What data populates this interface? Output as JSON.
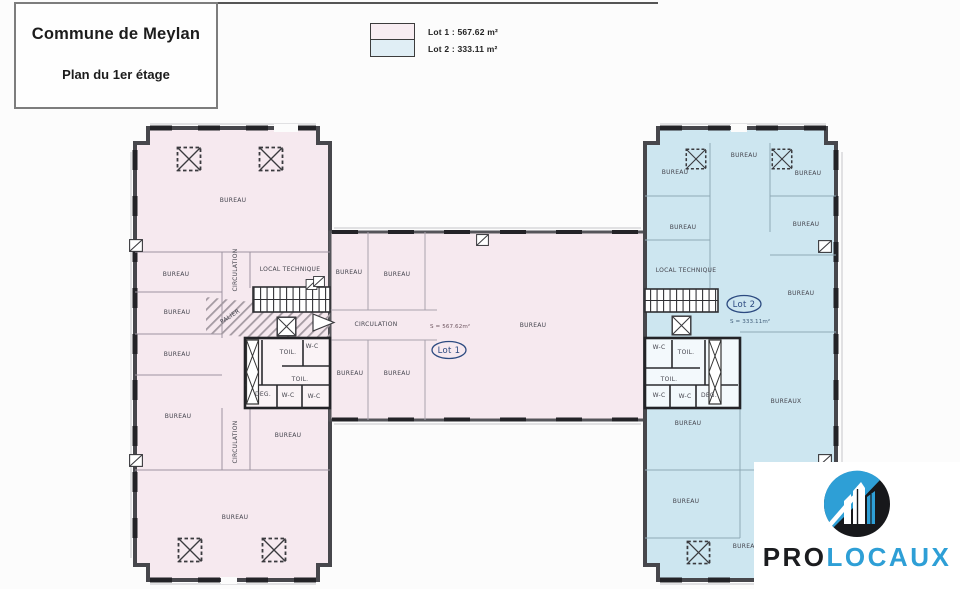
{
  "title_block": {
    "line1": "Commune de Meylan",
    "line2": "Plan du 1er étage"
  },
  "legend": {
    "items": [
      {
        "label": "Lot 1 : 567.62 m²",
        "swatch_color": "#f8edf2"
      },
      {
        "label": "Lot 2 : 333.11 m²",
        "swatch_color": "#e0eef5"
      }
    ]
  },
  "plan": {
    "lot1": {
      "label": "Lot 1",
      "area_label": "S = 567.62m²",
      "fill": "#f6e9ef"
    },
    "lot2": {
      "label": "Lot 2",
      "area_label": "S = 333.11m²",
      "fill": "#cde6f0"
    },
    "rooms": [
      {
        "t": "BUREAU",
        "x": 233,
        "y": 202
      },
      {
        "t": "BUREAU",
        "x": 176,
        "y": 276
      },
      {
        "t": "BUREAU",
        "x": 177,
        "y": 314
      },
      {
        "t": "BUREAU",
        "x": 177,
        "y": 356
      },
      {
        "t": "BUREAU",
        "x": 178,
        "y": 418
      },
      {
        "t": "CIRCULATION",
        "x": 237,
        "y": 270,
        "r": -90
      },
      {
        "t": "LOCAL TECHNIQUE",
        "x": 290,
        "y": 271
      },
      {
        "t": "PALIER",
        "x": 231,
        "y": 318,
        "r": -33
      },
      {
        "t": "TOIL.",
        "x": 288,
        "y": 354
      },
      {
        "t": "W-C",
        "x": 312,
        "y": 348
      },
      {
        "t": "TOIL.",
        "x": 300,
        "y": 381
      },
      {
        "t": "DEG.",
        "x": 263,
        "y": 396
      },
      {
        "t": "W-C",
        "x": 288,
        "y": 397
      },
      {
        "t": "W-C",
        "x": 314,
        "y": 398
      },
      {
        "t": "CIRCULATION",
        "x": 237,
        "y": 442,
        "r": -90
      },
      {
        "t": "BUREAU",
        "x": 288,
        "y": 437
      },
      {
        "t": "BUREAU",
        "x": 235,
        "y": 519
      },
      {
        "t": "BUREAU",
        "x": 349,
        "y": 274
      },
      {
        "t": "BUREAU",
        "x": 397,
        "y": 276
      },
      {
        "t": "CIRCULATION",
        "x": 376,
        "y": 326
      },
      {
        "t": "BUREAU",
        "x": 533,
        "y": 327
      },
      {
        "t": "BUREAU",
        "x": 350,
        "y": 375
      },
      {
        "t": "BUREAU",
        "x": 397,
        "y": 375
      },
      {
        "t": "BUREAU",
        "x": 744,
        "y": 157
      },
      {
        "t": "BUREAU",
        "x": 675,
        "y": 174
      },
      {
        "t": "BUREAU",
        "x": 808,
        "y": 175
      },
      {
        "t": "BUREAU",
        "x": 683,
        "y": 229
      },
      {
        "t": "BUREAU",
        "x": 806,
        "y": 226
      },
      {
        "t": "LOCAL TECHNIQUE",
        "x": 686,
        "y": 272
      },
      {
        "t": "BUREAU",
        "x": 801,
        "y": 295
      },
      {
        "t": "W-C",
        "x": 659,
        "y": 349
      },
      {
        "t": "TOIL.",
        "x": 686,
        "y": 354
      },
      {
        "t": "TOIL.",
        "x": 669,
        "y": 381
      },
      {
        "t": "W-C",
        "x": 659,
        "y": 397
      },
      {
        "t": "W-C",
        "x": 685,
        "y": 398
      },
      {
        "t": "DEG.",
        "x": 709,
        "y": 397
      },
      {
        "t": "BUREAUX",
        "x": 786,
        "y": 403
      },
      {
        "t": "BUREAU",
        "x": 688,
        "y": 425
      },
      {
        "t": "BUREAU",
        "x": 686,
        "y": 503
      },
      {
        "t": "BUREAU",
        "x": 746,
        "y": 548
      }
    ]
  },
  "logo": {
    "text_black": "PRO",
    "text_blue": "LOCAUX",
    "black": "#1b1c1f",
    "blue": "#2e9fd6"
  },
  "icons": {
    "skylight_symbol": "dashed-square-with-x",
    "elevator_symbol": "square-with-x",
    "door_symbol": "square-with-diagonal",
    "stairs_symbol": "parallel-treads",
    "logo_mark": "circle-with-buildings"
  }
}
